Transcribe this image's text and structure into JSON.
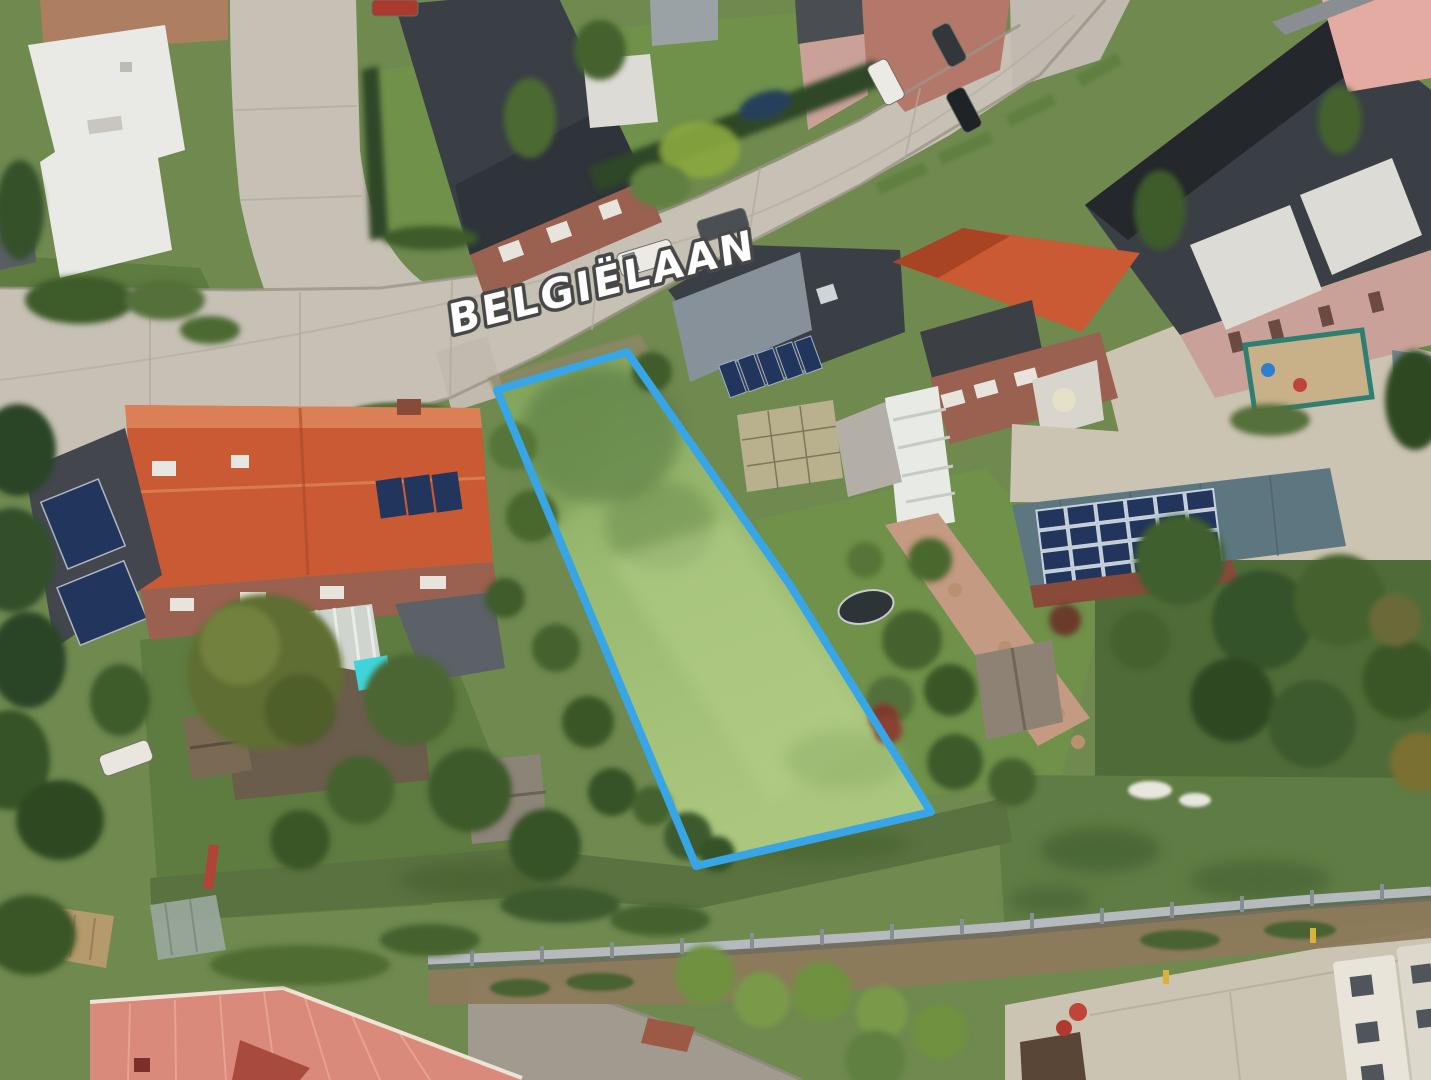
{
  "image": {
    "kind": "oblique-aerial-photograph",
    "description": "Aerial 3D view of a residential neighbourhood with a vacant grass building plot outlined in blue beside the street Belgiëlaan",
    "width_px": 1431,
    "height_px": 1080
  },
  "street_label": {
    "text": "BELGIËLAAN",
    "fill": "#FFFFFF",
    "outline": "#474747",
    "rotation_deg": -14,
    "font_size_px": 41
  },
  "parcel": {
    "outline_color": "#38A5E6",
    "outline_width_px": 8,
    "fill_note": "tall mown grass",
    "vertices_px": [
      [
        497,
        390
      ],
      [
        627,
        352
      ],
      [
        790,
        585
      ],
      [
        931,
        812
      ],
      [
        696,
        866
      ]
    ]
  },
  "palette": {
    "base_green": "#6F894F",
    "road": "#C7C1B5",
    "asphalt": "#A19A8F",
    "concrete_pad": "#CCC4B2",
    "brick_pavement": "#AD7E62",
    "lawn": "#6F9149",
    "wild_grass": "#5A7140",
    "field": "#5F7C44",
    "hedge_dark": "#2E4627",
    "tree_dark": "#34512A",
    "tree_mid": "#4C6A33",
    "tree_olive": "#5F6E33",
    "verge": "#5E8040",
    "orange_roof": "#C95A33",
    "coral_roof": "#D98A7A",
    "dark_roof": "#3A3F46",
    "slate_roof": "#5D7680",
    "solar_panel": "#22355C",
    "brick_wall": "#9A6050",
    "pink_wall": "#C9A198",
    "salmon_house": "#E3ABA1",
    "white_building": "#E9E9E5",
    "white_roof": "#DCDBD5",
    "veranda": "#E8EAE6",
    "fence": "#B4BABE",
    "dirt": "#8C7A5C",
    "shed": "#8D8274",
    "shed_tan": "#B59A6D",
    "path_brick": "#C49A82",
    "pool": "#3FD4D8",
    "trailer": "#E8E4DA",
    "dumpster": "#5A4636",
    "car_white": "#ECEAE4",
    "car_dark": "#4A4F54",
    "car_red": "#A93A2D",
    "parcel_grass_top": "#7FA158",
    "parcel_grass_bottom": "#ABC77D"
  }
}
